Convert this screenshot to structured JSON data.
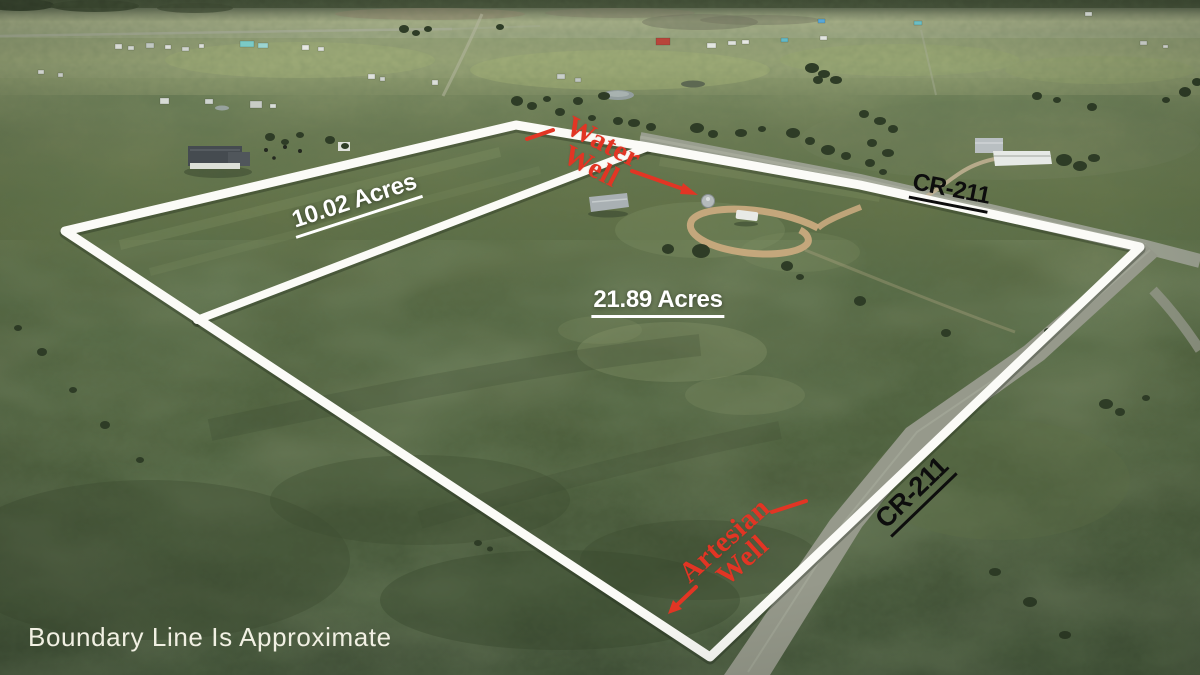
{
  "annotations": {
    "parcel_small": "10.02 Acres",
    "parcel_large": "21.89 Acres",
    "road_label_top": "CR-211",
    "road_label_bottom": "CR-211",
    "water_well": {
      "line1": "Water",
      "line2": "Well"
    },
    "artesian_well": {
      "line1": "Artesian",
      "line2": "Well"
    },
    "disclaimer": "Boundary Line Is Approximate"
  },
  "colors": {
    "boundary_line": "#fbfbf7",
    "annotation_red": "#e23524",
    "road_label_black": "#0d0d0d",
    "acreage_white": "#ffffff",
    "disclaimer_cream": "#f1f0e3"
  }
}
